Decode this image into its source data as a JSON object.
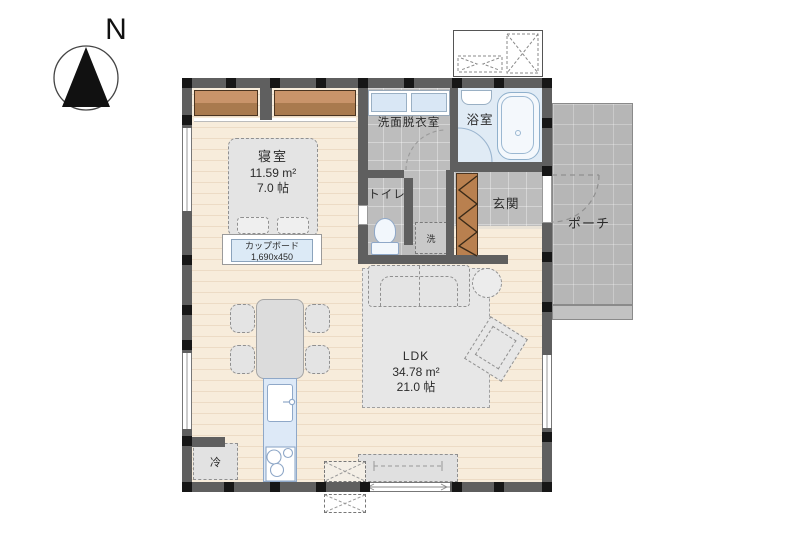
{
  "compass": {
    "north_label": "N"
  },
  "rooms": {
    "bedroom": {
      "name": "寝室",
      "area_m2": "11.59 m²",
      "area_tatami": "7.0 帖"
    },
    "washroom": {
      "name": "洗面脱衣室"
    },
    "bathroom": {
      "name": "浴室"
    },
    "toilet": {
      "name": "トイレ"
    },
    "entrance": {
      "name": "玄関"
    },
    "porch": {
      "name": "ポーチ"
    },
    "ldk": {
      "name": "LDK",
      "area_m2": "34.78 m²",
      "area_tatami": "21.0 帖"
    }
  },
  "fixtures": {
    "cupboard": {
      "name": "カップボード",
      "size": "1,690x450"
    },
    "refrigerator": {
      "label": "冷"
    },
    "washing_machine": {
      "label": "洗"
    }
  },
  "colors": {
    "wall": "#5f5f5f",
    "column": "#161616",
    "wood_floor": "#f7ecdb",
    "tile_floor": "#bdbdbd",
    "porch_tile": "#b6b6b6",
    "bath_floor": "#e0ebf5",
    "closet_wood": "#b9804f",
    "kitchen_counter": "#dde9f7",
    "furniture_gray": "#e4e4e4",
    "cupboard_label_bg": "#dceaf6"
  }
}
